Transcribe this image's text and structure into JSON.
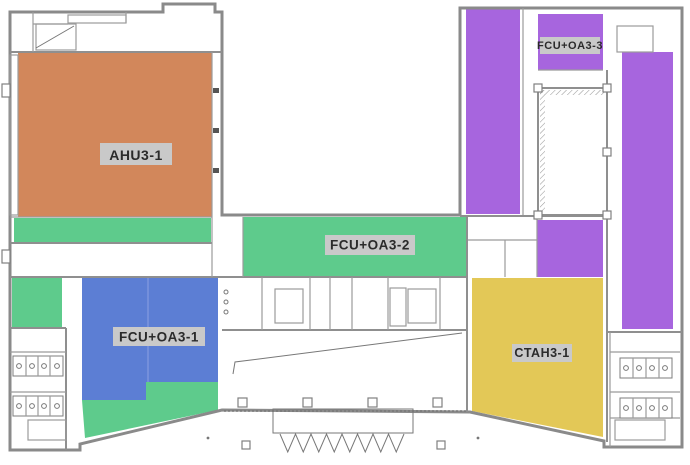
{
  "diagram": {
    "kind": "building-floor-plan-hvac-zoning",
    "background_color": "#ffffff",
    "wall_color": "#8a8a8a",
    "label_box_color": "#c9c9c9",
    "label_text_color": "#2b2b2b"
  },
  "zones": [
    {
      "id": "ahu3-1",
      "label": "AHU3-1",
      "color": "#d2875b",
      "location": "upper-left"
    },
    {
      "id": "fcu-oa3-1",
      "label": "FCU+OA3-1",
      "color": "#5c7ed4",
      "location": "lower-left"
    },
    {
      "id": "fcu-oa3-2",
      "label": "FCU+OA3-2",
      "color": "#5ecb8c",
      "location": "center-strip"
    },
    {
      "id": "fcu-oa3-3",
      "label": "FCU+OA3-3",
      "color": "#a765de",
      "location": "upper-right"
    },
    {
      "id": "ctah3-1",
      "label": "CTAH3-1",
      "color": "#e3c857",
      "location": "lower-right"
    }
  ]
}
